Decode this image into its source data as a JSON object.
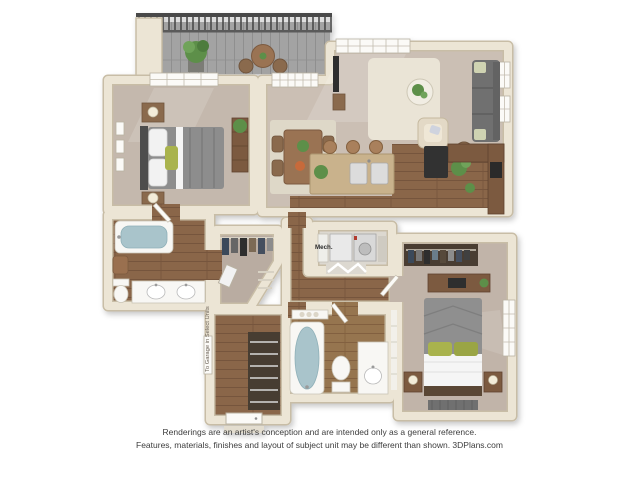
{
  "image": {
    "width": 639,
    "height": 479,
    "background": "#ffffff",
    "description": "3D rendered apartment floor plan, two bedrooms, two bathrooms, kitchen with island, balcony"
  },
  "disclaimer": {
    "line1": "Renderings are an artist's conception and are intended only as a general reference.",
    "line2": "Features, materials, finishes and layout of subject unit may be different than shown. 3DPlans.com"
  },
  "floorplan": {
    "labels": {
      "mech": "Mech.",
      "garage_note": "To Garage in Select Units"
    },
    "palette": {
      "wall": "#ece5d5",
      "wall_edge": "#c8bda6",
      "carpet": "#c4b8ad",
      "carpet_living": "#cbbfb4",
      "wood_floor": "#8a664a",
      "deck_gray": "#a3a3a3",
      "railing_dark": "#4a4a4a",
      "fixture_white": "#f8f7f4",
      "tub_water": "#a9c4cb",
      "sofa_gray": "#6f6f6f",
      "accent_green": "#a9b34e",
      "plant_green": "#5d8f4a",
      "island_tan": "#c9b28c",
      "counter_brown": "#7c5a40",
      "appliance_dark": "#303030",
      "text_gray": "#3d3d3d"
    }
  }
}
